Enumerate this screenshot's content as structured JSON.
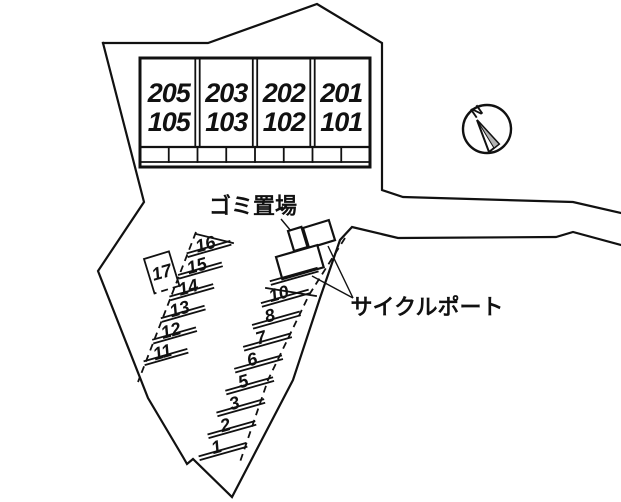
{
  "title": "敷地配置図",
  "building": {
    "units": [
      {
        "upper": "205",
        "lower": "105"
      },
      {
        "upper": "203",
        "lower": "103"
      },
      {
        "upper": "202",
        "lower": "102"
      },
      {
        "upper": "201",
        "lower": "101"
      }
    ]
  },
  "labels": {
    "garbage": "ゴミ置場",
    "cycle_port": "サイクルポート",
    "compass_north": "N"
  },
  "parking": {
    "right_column_bottom_to_top": [
      "1",
      "2",
      "3",
      "5",
      "6",
      "7",
      "8",
      "10"
    ],
    "left_column_bottom_to_top": [
      "11",
      "12",
      "13",
      "14",
      "15",
      "16"
    ],
    "separate_stall": "17"
  },
  "colors": {
    "line": "#111111",
    "background": "#ffffff",
    "needle_shade": "#b3b3b3"
  }
}
